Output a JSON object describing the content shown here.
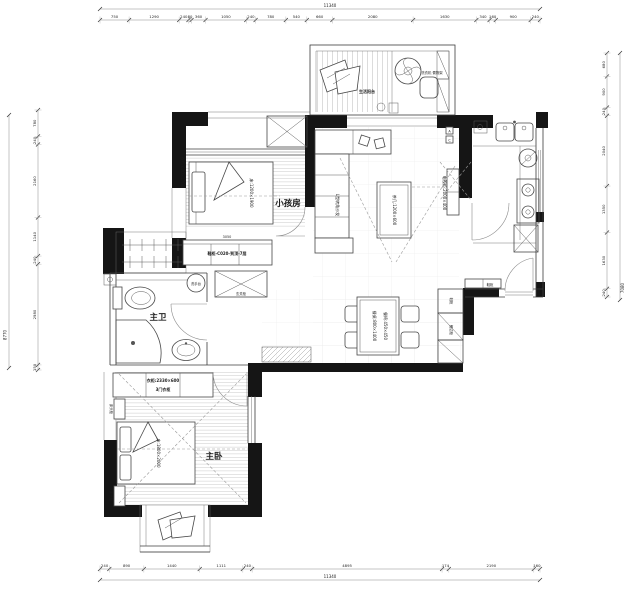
{
  "dimensions": {
    "top": {
      "total": "11340",
      "segments": [
        "750",
        "1290",
        "240",
        "80",
        "360",
        "1050",
        "240",
        "780",
        "540",
        "660",
        "2080",
        "1630",
        "340",
        "160",
        "900",
        "240"
      ]
    },
    "bottom": {
      "total": "11340",
      "segments": [
        "240",
        "890",
        "1440",
        "1111",
        "240",
        "4895",
        "174",
        "2190",
        "160"
      ]
    },
    "left": {
      "total": "8770",
      "segments": [
        "780",
        "240",
        "2160",
        "1140",
        "240",
        "2980",
        "150"
      ]
    },
    "right": {
      "total": "7080",
      "segments": [
        "680",
        "900",
        "240",
        "2040",
        "1350",
        "1630",
        "240"
      ]
    }
  },
  "rooms": {
    "kids_room": "小孩房",
    "master_bath": "主卫",
    "master_bedroom": "主卧",
    "service_balcony": "生活阳台"
  },
  "furniture": {
    "kids_bed": "床:1200×1900",
    "kids_wardrobe": "衣柜:600×1700",
    "master_bed": "床:1800×2000",
    "master_wardrobe_line1": "衣柜:2330×600",
    "master_wardrobe_line2": "3门衣柜",
    "nightstand": "床头柜",
    "sofa": "L型转角沙发",
    "coffee_table": "茶几:1200×600",
    "tv_cabinet": "电视柜:2000×400",
    "dining_table": "餐桌:800×1400",
    "dining_chair": "餐椅:450×450",
    "sideboard": "餐边柜",
    "shoe_cabinet": "鞋柜",
    "entry_cabinet": "鞋柜-C020-到顶-7层",
    "entry_cabinet_dim": "3050",
    "storage_cabinet": "玄关柜",
    "washbasin_callout": "洗手台",
    "washer_shelf": "洗衣机·置物架",
    "grid_label_a": "A",
    "grid_label_c": "C"
  }
}
